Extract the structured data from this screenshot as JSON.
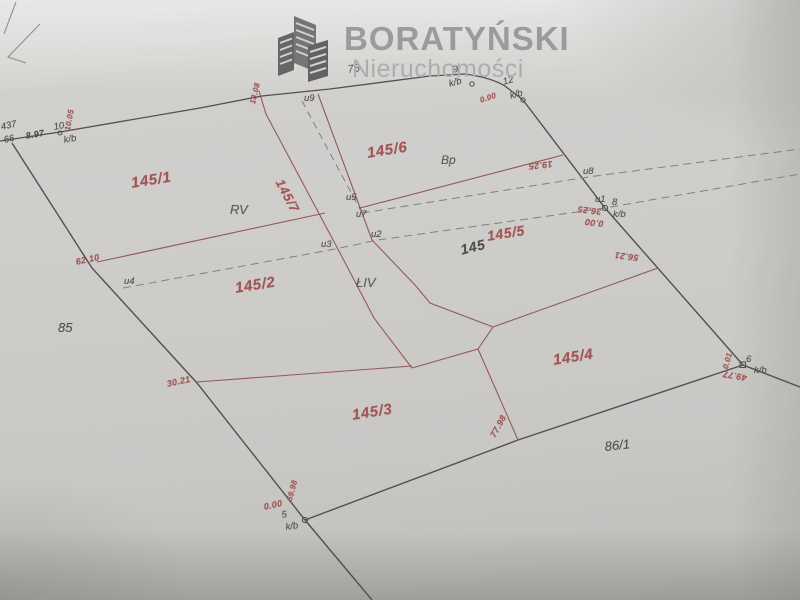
{
  "logo": {
    "name": "BORATYŃSKI",
    "subtitle": "Nieruchomości",
    "icon": "buildings-icon"
  },
  "map": {
    "parcels": {
      "p145_1": "145/1",
      "p145_2": "145/2",
      "p145_3": "145/3",
      "p145_4": "145/4",
      "p145_5": "145/5",
      "p145_6": "145/6",
      "p145_7": "145/7",
      "p145_old": "145",
      "p85": "85",
      "p86_1": "86/1",
      "p76": "76",
      "p437": "437",
      "p66": "66"
    },
    "soil": {
      "rv": "RV",
      "bp": "Bp",
      "liv": "ŁIV"
    },
    "points": {
      "u1": "u1",
      "u2": "u2",
      "u3": "u3",
      "u4": "u4",
      "u5": "u5",
      "u7": "u7",
      "u8": "u8",
      "u9": "u9",
      "n5": "5",
      "n6": "6",
      "n8": "8",
      "n9": "9",
      "n10": "10",
      "n12": "12",
      "kb": "k/b"
    },
    "meas": {
      "m8_97": "8.97",
      "m10_05": "10.05",
      "m18_08": "18.08",
      "m19_25": "19.25",
      "m36_25": "36.25",
      "m0_00": "0.00",
      "m0_01": "0.01",
      "m49_77": "49.77",
      "m56_21": "56.21",
      "m62_10": "62.10",
      "m30_21": "30.21",
      "m77_98": "77.98",
      "m59_98": "59.98"
    },
    "colors": {
      "paper": "#d3d1ce",
      "boundary_line": "#414141",
      "subdivision_line": "#8f4a4a",
      "dashed_line": "#787878",
      "parcel_label": "#9e4646",
      "soil_label": "#4c5044",
      "logo_text": "#989898",
      "logo_subtext": "#adadad"
    }
  }
}
